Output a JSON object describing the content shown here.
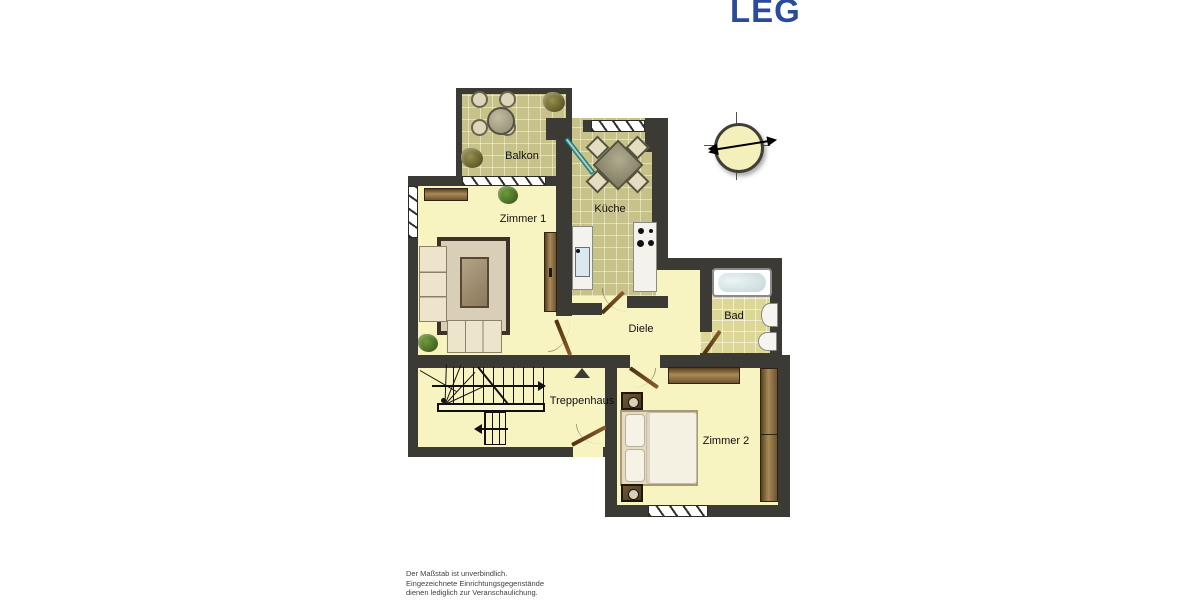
{
  "logo": {
    "text": "LEG",
    "color": "#2b4a9c"
  },
  "plan": {
    "rooms": [
      {
        "id": "balkon",
        "label": "Balkon"
      },
      {
        "id": "zimmer1",
        "label": "Zimmer 1"
      },
      {
        "id": "kueche",
        "label": "Küche"
      },
      {
        "id": "diele",
        "label": "Diele"
      },
      {
        "id": "bad",
        "label": "Bad"
      },
      {
        "id": "treppenhaus",
        "label": "Treppenhaus"
      },
      {
        "id": "zimmer2",
        "label": "Zimmer 2"
      }
    ],
    "colors": {
      "wall": "#3b3a34",
      "floor": "#f8f4c2",
      "tile_dark": "#c6c28a",
      "tile_light": "#ddd795",
      "door_brown": "#8a5c28",
      "glass_teal": "#6fc0bd",
      "logo_blue": "#2b4a9c"
    }
  },
  "disclaimer": {
    "line1": "Der Maßstab ist unverbindlich.",
    "line2": "Eingezeichnete Einrichtungsgegenstände",
    "line3": "dienen lediglich zur Veranschaulichung."
  }
}
